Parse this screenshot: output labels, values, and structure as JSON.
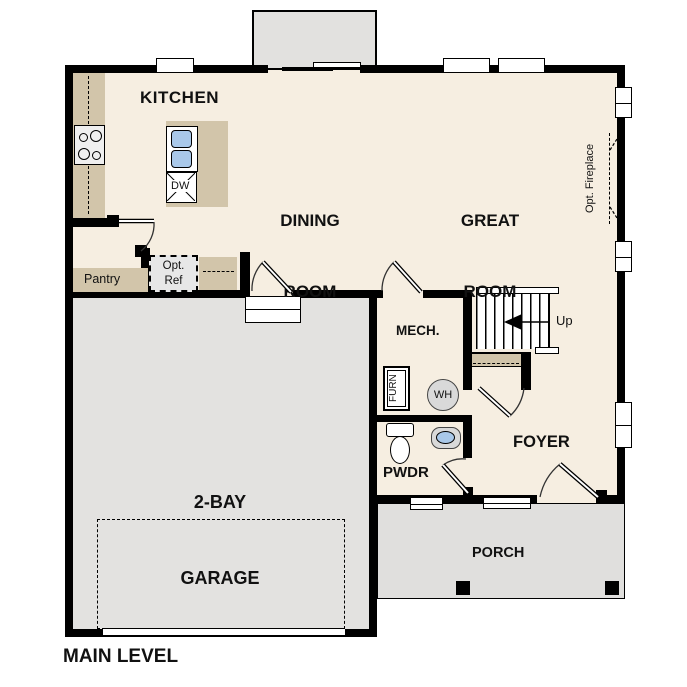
{
  "plan": {
    "title": "MAIN LEVEL",
    "rooms": {
      "kitchen": "KITCHEN",
      "dining_room": [
        "DINING",
        "ROOM"
      ],
      "great_room": [
        "GREAT",
        "ROOM"
      ],
      "mech": "MECH.",
      "garage": [
        "2-BAY",
        "GARAGE"
      ],
      "pwdr": "PWDR",
      "foyer": "FOYER",
      "porch": "PORCH",
      "pantry": "Pantry"
    },
    "annotations": {
      "opt_ref": [
        "Opt.",
        "Ref"
      ],
      "opt_fireplace": "Opt. Fireplace",
      "up": "Up",
      "dw": "DW",
      "furn": "FURN",
      "wh": "WH"
    },
    "colors": {
      "floor": "#f6eee1",
      "garage_floor": "#e3e2e0",
      "porch_floor": "#e0dfdd",
      "counter": "#d2c5aa",
      "wall": "#000000",
      "fixture_blue": "#a9c8e9",
      "appliance_gray": "#d9d9d9",
      "bumpout_gray": "#e2e1df"
    }
  }
}
